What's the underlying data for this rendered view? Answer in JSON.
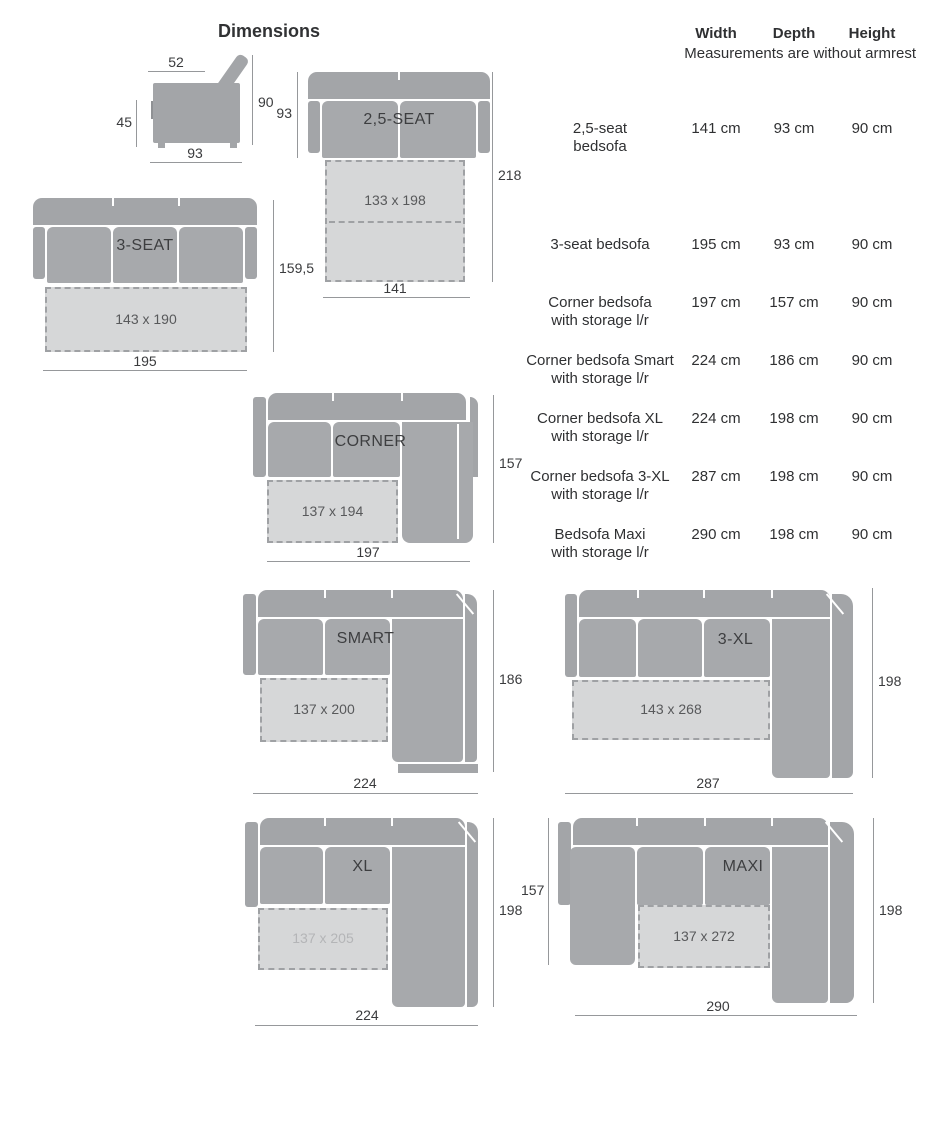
{
  "title": "Dimensions",
  "table": {
    "columns": [
      "Width",
      "Depth",
      "Height"
    ],
    "note": "Measurements are without armrest",
    "rows": [
      {
        "name_line1": "2,5-seat",
        "name_line2": "bedsofa",
        "width": "141 cm",
        "depth": "93 cm",
        "height": "90 cm"
      },
      {
        "name_line1": "3-seat bedsofa",
        "name_line2": "",
        "width": "195 cm",
        "depth": "93 cm",
        "height": "90 cm"
      },
      {
        "name_line1": "Corner bedsofa",
        "name_line2": "with storage l/r",
        "width": "197 cm",
        "depth": "157 cm",
        "height": "90 cm"
      },
      {
        "name_line1": "Corner bedsofa Smart",
        "name_line2": "with storage l/r",
        "width": "224 cm",
        "depth": "186 cm",
        "height": "90 cm"
      },
      {
        "name_line1": "Corner bedsofa XL",
        "name_line2": "with storage l/r",
        "width": "224 cm",
        "depth": "198 cm",
        "height": "90 cm"
      },
      {
        "name_line1": "Corner bedsofa 3-XL",
        "name_line2": "with storage l/r",
        "width": "287 cm",
        "depth": "198 cm",
        "height": "90 cm"
      },
      {
        "name_line1": "Bedsofa Maxi",
        "name_line2": "with storage l/r",
        "width": "290 cm",
        "depth": "198 cm",
        "height": "90 cm"
      }
    ]
  },
  "diagrams": {
    "side": {
      "top": "52",
      "left": "45",
      "right": "90",
      "bottom": "93"
    },
    "s25": {
      "label": "2,5-SEAT",
      "mattress": "133 x 198",
      "left": "93",
      "right": "218",
      "bottom": "141"
    },
    "s3": {
      "label": "3-SEAT",
      "mattress": "143 x 190",
      "right": "159,5",
      "bottom": "195"
    },
    "corner": {
      "label": "CORNER",
      "mattress": "137 x 194",
      "right": "157",
      "bottom": "197"
    },
    "smart": {
      "label": "SMART",
      "mattress": "137 x 200",
      "right": "186",
      "bottom": "224"
    },
    "xl3": {
      "label": "3-XL",
      "mattress": "143 x 268",
      "right": "198",
      "bottom": "287"
    },
    "xl": {
      "label": "XL",
      "mattress": "137 x 205",
      "right": "198",
      "bottom": "224"
    },
    "maxi": {
      "label": "MAXI",
      "mattress": "137 x 272",
      "left": "157",
      "right": "198",
      "bottom": "290"
    }
  },
  "colors": {
    "sofa": "#a3a5a8",
    "cushion": "#a7a9ac",
    "mattress": "#d6d7d8",
    "dash_border": "#9fa1a4",
    "dim_line": "#96989b",
    "text": "#2f3032",
    "faded_text": "#b4b5b7"
  }
}
